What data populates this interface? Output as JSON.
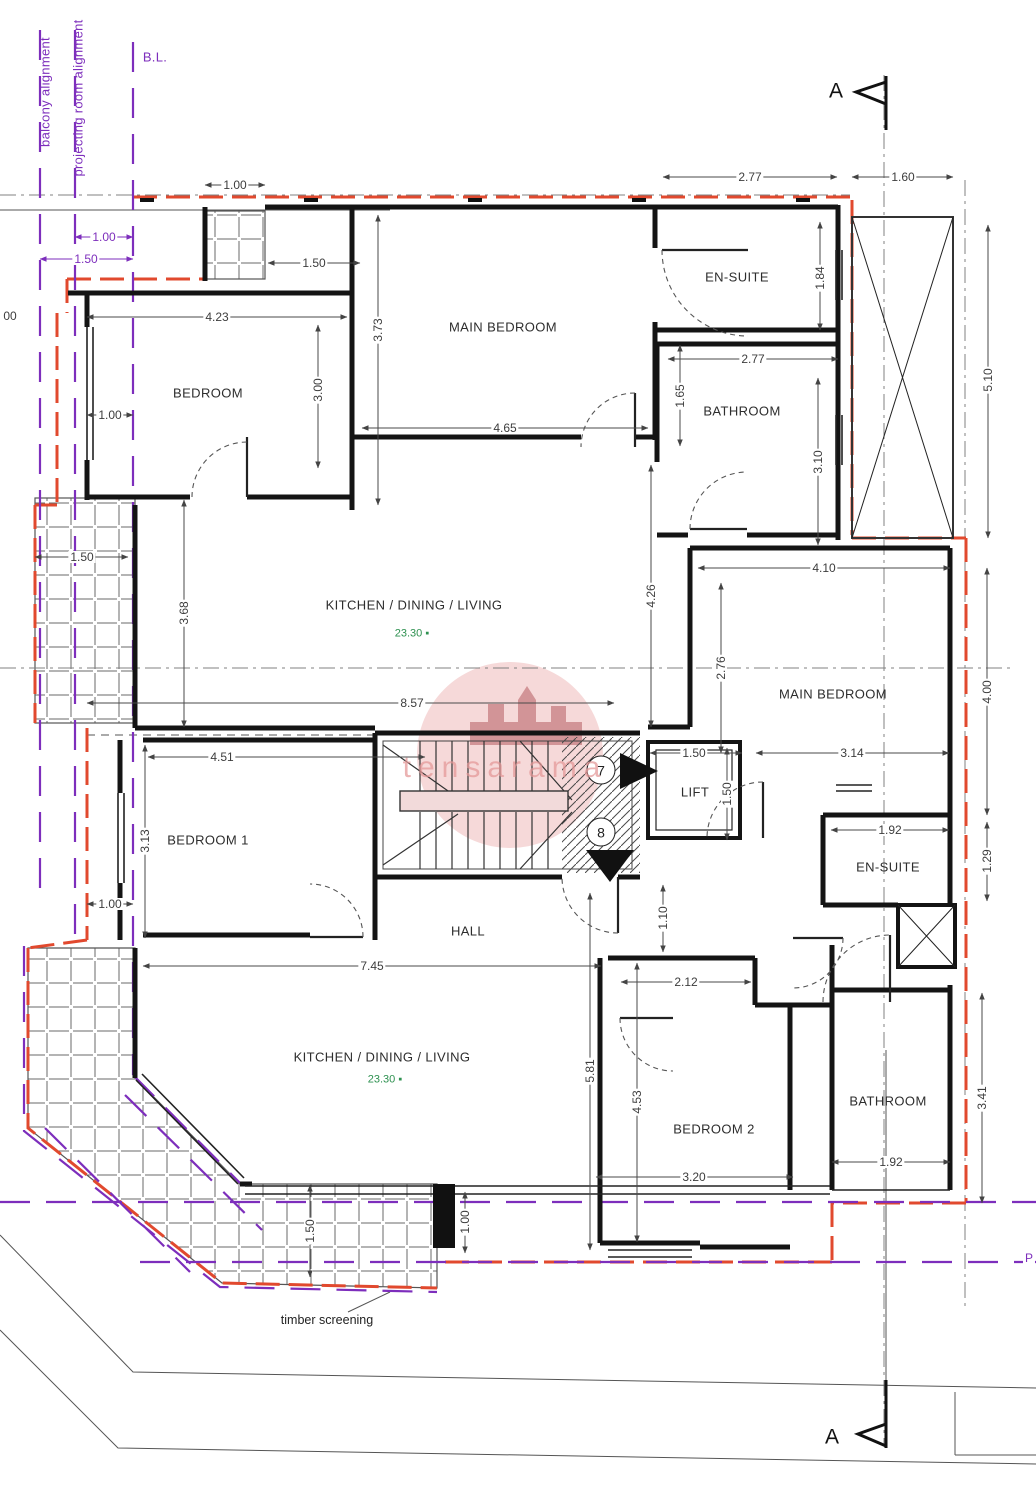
{
  "plan": {
    "title": "apartment floor plan",
    "colors": {
      "boundary_red": "#e1492e",
      "alignment_purple": "#7d2ebc",
      "area_green": "#2e9150",
      "wall_black": "#141414",
      "watermark_pink": "#e39696"
    },
    "rooms": [
      {
        "n": "EN-SUITE",
        "x": 737,
        "y": 277
      },
      {
        "n": "MAIN BEDROOM",
        "x": 503,
        "y": 327
      },
      {
        "n": "BEDROOM",
        "x": 208,
        "y": 393
      },
      {
        "n": "BATHROOM",
        "x": 742,
        "y": 411
      },
      {
        "n": "KITCHEN / DINING / LIVING",
        "x": 414,
        "y": 605
      },
      {
        "n": "MAIN BEDROOM",
        "x": 833,
        "y": 694
      },
      {
        "n": "BEDROOM 1",
        "x": 208,
        "y": 840
      },
      {
        "n": "HALL",
        "x": 468,
        "y": 931
      },
      {
        "n": "LIFT",
        "x": 695,
        "y": 792
      },
      {
        "n": "EN-SUITE",
        "x": 888,
        "y": 867
      },
      {
        "n": "KITCHEN / DINING / LIVING",
        "x": 382,
        "y": 1057
      },
      {
        "n": "BEDROOM 2",
        "x": 714,
        "y": 1129
      },
      {
        "n": "BATHROOM",
        "x": 888,
        "y": 1101
      }
    ],
    "areas": [
      {
        "v": "23.30 ▪",
        "x": 412,
        "y": 634
      },
      {
        "v": "23.30 ▪",
        "x": 385,
        "y": 1080
      }
    ],
    "dimensions": [
      {
        "v": "1.00",
        "x": 235,
        "y": 185
      },
      {
        "v": "1.50",
        "x": 314,
        "y": 263
      },
      {
        "v": "1.00",
        "x": 104,
        "y": 237,
        "c": 1
      },
      {
        "v": "1.50",
        "x": 86,
        "y": 259,
        "c": 1
      },
      {
        "v": "4.23",
        "x": 217,
        "y": 317
      },
      {
        "v": "3.73",
        "x": 378,
        "y": 330,
        "r": 1
      },
      {
        "v": "3.00",
        "x": 318,
        "y": 390,
        "r": 1
      },
      {
        "v": "1.00",
        "x": 110,
        "y": 415
      },
      {
        "v": "2.77",
        "x": 750,
        "y": 177
      },
      {
        "v": "1.60",
        "x": 903,
        "y": 177
      },
      {
        "v": "1.84",
        "x": 820,
        "y": 278,
        "r": 1
      },
      {
        "v": "5.10",
        "x": 988,
        "y": 380,
        "r": 1
      },
      {
        "v": "4.65",
        "x": 505,
        "y": 428
      },
      {
        "v": "1.65",
        "x": 680,
        "y": 396,
        "r": 1
      },
      {
        "v": "2.77",
        "x": 753,
        "y": 359
      },
      {
        "v": "3.10",
        "x": 818,
        "y": 462,
        "r": 1
      },
      {
        "v": "1.50",
        "x": 82,
        "y": 557
      },
      {
        "v": "3.68",
        "x": 184,
        "y": 613,
        "r": 1
      },
      {
        "v": "4.26",
        "x": 651,
        "y": 596,
        "r": 1
      },
      {
        "v": "2.76",
        "x": 721,
        "y": 668,
        "r": 1
      },
      {
        "v": "4.10",
        "x": 824,
        "y": 568
      },
      {
        "v": "4.00",
        "x": 987,
        "y": 692,
        "r": 1
      },
      {
        "v": "8.57",
        "x": 412,
        "y": 703
      },
      {
        "v": "4.51",
        "x": 222,
        "y": 757
      },
      {
        "v": "1.50",
        "x": 694,
        "y": 753
      },
      {
        "v": "1.50",
        "x": 727,
        "y": 794,
        "r": 1
      },
      {
        "v": "3.14",
        "x": 852,
        "y": 753
      },
      {
        "v": "3.13",
        "x": 145,
        "y": 841,
        "r": 1
      },
      {
        "v": "1.92",
        "x": 890,
        "y": 830
      },
      {
        "v": "1.29",
        "x": 987,
        "y": 861,
        "r": 1
      },
      {
        "v": "1.00",
        "x": 110,
        "y": 904
      },
      {
        "v": "1.10",
        "x": 663,
        "y": 918,
        "r": 1
      },
      {
        "v": "7.45",
        "x": 372,
        "y": 966
      },
      {
        "v": "2.12",
        "x": 686,
        "y": 982
      },
      {
        "v": "5.81",
        "x": 590,
        "y": 1071,
        "r": 1
      },
      {
        "v": "4.53",
        "x": 637,
        "y": 1102,
        "r": 1
      },
      {
        "v": "3.41",
        "x": 982,
        "y": 1098,
        "r": 1
      },
      {
        "v": "3.20",
        "x": 694,
        "y": 1177
      },
      {
        "v": "1.92",
        "x": 891,
        "y": 1162
      },
      {
        "v": "1.50",
        "x": 310,
        "y": 1231,
        "r": 1
      },
      {
        "v": "1.00",
        "x": 465,
        "y": 1222,
        "r": 1
      },
      {
        "v": "00",
        "x": 10,
        "y": 316
      },
      {
        "v": "P",
        "x": 1029,
        "y": 1258,
        "c": 1
      }
    ],
    "alignment_labels": [
      {
        "t": "balcony alignment",
        "x": 45,
        "y": 92,
        "r": 1
      },
      {
        "t": "projecting room alignment",
        "x": 78,
        "y": 98,
        "r": 1
      },
      {
        "t": "B.L.",
        "x": 155,
        "y": 57
      }
    ],
    "section_markers": [
      {
        "t": "A",
        "x": 836,
        "y": 91
      },
      {
        "t": "A",
        "x": 832,
        "y": 1437
      }
    ],
    "stair_markers": [
      {
        "t": "7",
        "x": 601,
        "y": 770
      },
      {
        "t": "8",
        "x": 601,
        "y": 832
      }
    ],
    "annotations": [
      {
        "t": "timber screening",
        "x": 327,
        "y": 1320
      }
    ],
    "watermark": {
      "t": "tensarama",
      "x": 505,
      "y": 768
    }
  }
}
